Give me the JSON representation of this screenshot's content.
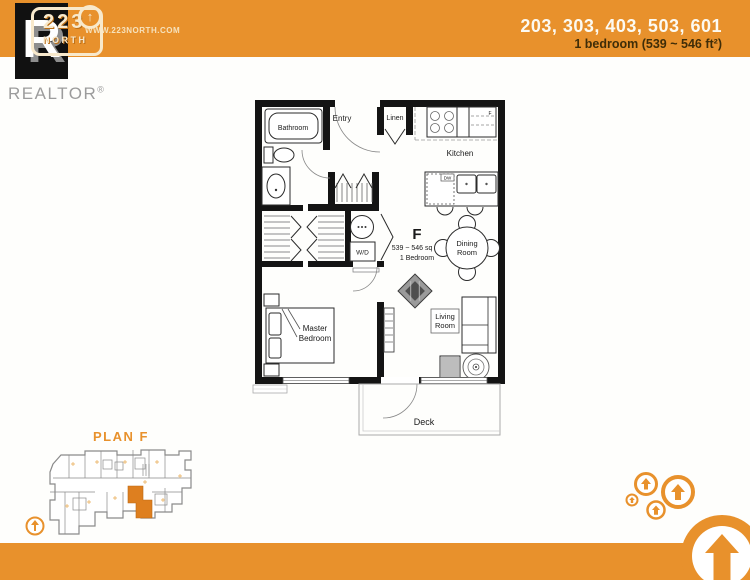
{
  "header": {
    "logo_line1": "223",
    "logo_line2": "NORTH",
    "logo_arrow": "↑",
    "website": "WWW.223NORTH.COM",
    "units": "203, 303, 403, 503, 601",
    "subtitle": "1 bedroom (539 ~ 546 ft²)"
  },
  "realtor": {
    "r": "R",
    "name": "REALTOR",
    "reg": "®"
  },
  "floorplan": {
    "unit": {
      "letter": "F",
      "area": "539 ~ 546 sq ft",
      "type": "1 Bedroom"
    },
    "rooms": {
      "bathroom": "Bathroom",
      "entry": "Entry",
      "linen": "Linen",
      "kitchen": "Kitchen",
      "dining1": "Dining",
      "dining2": "Room",
      "living1": "Living",
      "living2": "Room",
      "master1": "Master",
      "master2": "Bedroom",
      "deck": "Deck"
    },
    "appliances": {
      "wd": "W/D",
      "dw": "DW",
      "fridge": "F"
    }
  },
  "siteplan": {
    "title": "PLAN F",
    "north_label": "N"
  },
  "colors": {
    "orange": "#e8912c",
    "unit_orange": "#de7f1f",
    "plan_text_orange": "#dfa041"
  }
}
